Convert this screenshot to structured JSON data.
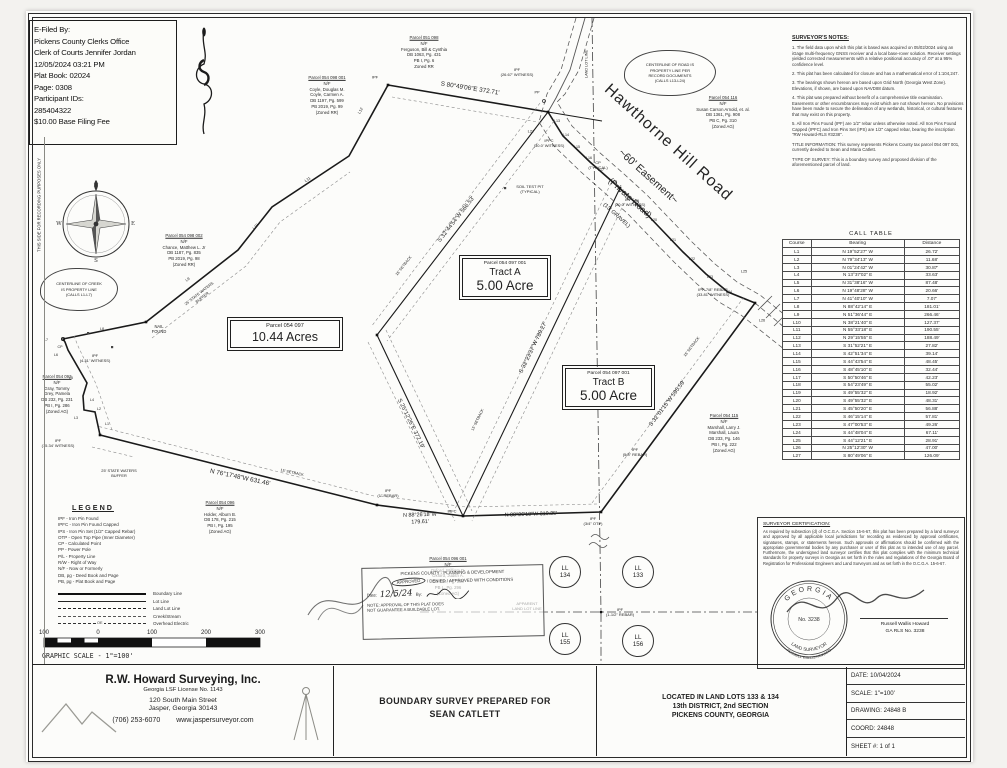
{
  "efile": {
    "lines": [
      "E-Filed By:",
      "Pickens County Clerks Office",
      "Clerk of Courts Jennifer Jordan",
      "12/05/2024 03:21 PM",
      "Plat Book: 02024",
      "Page: 0308",
      "Participant IDs:",
      "285404322",
      "$10.00 Base Filing Fee"
    ]
  },
  "surveyor_notes": {
    "title": "SURVEYOR'S NOTES:",
    "paragraphs": [
      "1. The field data upon which this plat is based was acquired on 05/02/2024 using an iGage multi-frequency GNSS receiver and a local base-rover solution. Receiver settings yielded corrected measurements with a relative positional accuracy of .07' at a 95% confidence level.",
      "2. This plat has been calculated for closure and has a mathematical error of 1:104,247.",
      "3. The bearings shown hereon are based upon Grid North (Georgia West Zone). Elevations, if shown, are based upon NAVD88 datum.",
      "4. This plat was prepared without benefit of a comprehensive title examination. Easements or other encumbrances may exist which are not shown hereon. No provisions have been made to secure the delineation of any wetlands, historical, or cultural features that may exist on this property.",
      "5. All Iron Pins Found (IPF) are 1/2\" rebar unless otherwise noted. All Iron Pins Found Capped (IPFC) and Iron Pins Set (IPS) are 1/2\" capped rebar, bearing the inscription \"RW Howard-RLS #3238\".",
      "TITLE INFORMATION: This survey represents Pickens County tax parcel 054 097 001, currently deeded to Sean and Maria Catlett.",
      "TYPE OF SURVEY: This is a boundary survey and proposed division of the aforementioned parcel of land."
    ]
  },
  "call_table": {
    "title": "CALL TABLE",
    "headers": [
      "Course",
      "Bearing",
      "Distance"
    ],
    "rows": [
      {
        "c": "L1",
        "b": "N 19°52'27\" W",
        "d": "26.72'"
      },
      {
        "c": "L2",
        "b": "N 79°34'13\" W",
        "d": "11.68'"
      },
      {
        "c": "L3",
        "b": "N 01°24'42\" W",
        "d": "30.87'"
      },
      {
        "c": "L4",
        "b": "N 13°37'02\" E",
        "d": "33.63'"
      },
      {
        "c": "L5",
        "b": "N 31°38'16\" W",
        "d": "87.48'"
      },
      {
        "c": "L6",
        "b": "N 19°48'28\" W",
        "d": "20.66'"
      },
      {
        "c": "L7",
        "b": "N 41°40'10\" W",
        "d": "7.07'"
      },
      {
        "c": "L8",
        "b": "N 88°42'14\" E",
        "d": "181.01'"
      },
      {
        "c": "L9",
        "b": "N 51°36'44\" E",
        "d": "266.46'"
      },
      {
        "c": "L10",
        "b": "N 38°21'40\" E",
        "d": "127.37'"
      },
      {
        "c": "L11",
        "b": "N 55°33'18\" E",
        "d": "190.55'"
      },
      {
        "c": "L12",
        "b": "N 29°15'55\" E",
        "d": "188.49'"
      },
      {
        "c": "L13",
        "b": "S 31°52'21\" E",
        "d": "27.82'"
      },
      {
        "c": "L14",
        "b": "S 42°51'34\" E",
        "d": "39.14'"
      },
      {
        "c": "L15",
        "b": "S 44°43'54\" E",
        "d": "48.45'"
      },
      {
        "c": "L16",
        "b": "S 48°45'10\" E",
        "d": "32.44'"
      },
      {
        "c": "L17",
        "b": "S 50°50'46\" E",
        "d": "42.23'"
      },
      {
        "c": "L18",
        "b": "S 54°23'49\" E",
        "d": "55.02'"
      },
      {
        "c": "L19",
        "b": "S 49°55'32\" E",
        "d": "18.92'"
      },
      {
        "c": "L20",
        "b": "S 49°55'32\" E",
        "d": "48.31'"
      },
      {
        "c": "L21",
        "b": "S 45°50'20\" E",
        "d": "56.88'"
      },
      {
        "c": "L22",
        "b": "S 46°15'14\" E",
        "d": "57.81'"
      },
      {
        "c": "L23",
        "b": "S 47°00'53\" E",
        "d": "49.26'"
      },
      {
        "c": "L24",
        "b": "S 44°48'04\" E",
        "d": "67.11'"
      },
      {
        "c": "L25",
        "b": "S 44°12'21\" E",
        "d": "28.91'"
      },
      {
        "c": "L26",
        "b": "N 25°12'30\" W",
        "d": "47.00'"
      },
      {
        "c": "L27",
        "b": "S 80°49'06\" E",
        "d": "126.09'"
      }
    ]
  },
  "road": {
    "name": "Hawthorne Hill Road",
    "easement": "~60' Easement~",
    "type": "(Private Road)",
    "surface": "(13' GRAVEL)"
  },
  "clouds": {
    "road": "CENTERLINE OF ROAD IS\nPROPERTY LINE PER\nRECORD DOCUMENTS\n(CALLS L13-L24)",
    "creek": "CENTERLINE OF CREEK\nIS PROPERTY LINE\n(CALLS L1-L7)"
  },
  "tracts": {
    "a": {
      "parcel": "Parcel 054 097 001",
      "name": "Tract A",
      "area": "5.00 Acre"
    },
    "b": {
      "parcel": "Parcel 054 097 001",
      "name": "Tract B",
      "area": "5.00 Acre"
    },
    "remainder": {
      "parcel": "Parcel 054 097",
      "area": "10.44 Acres"
    }
  },
  "adjoiners": [
    {
      "name": "parcel-ferguson",
      "x": 424,
      "y": 52,
      "w": 92,
      "lines": [
        "Parcel 051 098",
        "N/F",
        "Ferguson, Bill & Cynthia",
        "DB 1063, Pg. 431",
        "PB I, Pg. 6",
        "Zoned RR"
      ]
    },
    {
      "name": "parcel-coyle",
      "x": 327,
      "y": 95,
      "w": 66,
      "lines": [
        "Parcel 054 098 001",
        "N/F",
        "Coyle, Douglas M.",
        "Coyle, Carmen A.",
        "DB 1197, Pg. 599",
        "PB 2019, Pg. 99",
        "(Zoned RR)"
      ]
    },
    {
      "name": "parcel-chance",
      "x": 184,
      "y": 250,
      "w": 72,
      "lines": [
        "Parcel 054 098 002",
        "N/F",
        "Chance, Matthew L. Jr",
        "DB 1187, Pg. 835",
        "PB 2019, Pg. 98",
        "(Zoned RR)"
      ]
    },
    {
      "name": "parcel-gray",
      "x": 57,
      "y": 394,
      "w": 58,
      "lines": [
        "Parcel 054 093",
        "N/F",
        "Gray, Tommy",
        "Grey, Pamela",
        "DB 232, Pg. 231",
        "PB I, Pg. 286",
        "(Zoned AG)"
      ]
    },
    {
      "name": "parcel-arnold",
      "x": 723,
      "y": 112,
      "w": 82,
      "lines": [
        "Parcel 054 116",
        "N/F",
        "Susan Carson Arnold, et. al.",
        "DB 1361, Pg. 908",
        "PB C, Pg. 310",
        "(Zoned AG)"
      ]
    },
    {
      "name": "parcel-marshall",
      "x": 724,
      "y": 433,
      "w": 66,
      "lines": [
        "Parcel 054 115",
        "N/F",
        "Marshall, Larry J.",
        "Marshall, Laura",
        "DB 233, Pg. 146",
        "PB I, Pg. 222",
        "(Zoned AG)"
      ]
    },
    {
      "name": "parcel-holder",
      "x": 220,
      "y": 517,
      "w": 62,
      "lines": [
        "Parcel 054 096",
        "N/F",
        "Holder, Alburn B.",
        "DB 178, Pg. 215",
        "PB I, Pg. 195",
        "(Zoned AG)"
      ]
    },
    {
      "name": "parcel-oxford",
      "x": 448,
      "y": 576,
      "w": 66,
      "lines": [
        "Parcel 054 096 001",
        "N/F",
        "Oxford, William D.",
        "Oxford, Judith A.",
        "DB 136, Pg. 198",
        "PB L, Pg. 296",
        "(Zoned AG)"
      ]
    }
  ],
  "map_labels": [
    {
      "n": "bearing-top",
      "t": "S 80°49'06\"E 372.71'",
      "x": 470,
      "y": 89,
      "r": 9,
      "s": 6.3
    },
    {
      "n": "bearing-interior-1",
      "t": "S 32°44'54\"W 566.53'",
      "x": 457,
      "y": 220,
      "r": -52,
      "s": 5.8
    },
    {
      "n": "bearing-interior-2",
      "t": "S 25°12'26\"E 372.19'",
      "x": 410,
      "y": 424,
      "r": 64,
      "s": 5.8
    },
    {
      "n": "bearing-division",
      "t": "S 32°23'37\"W 789.27'",
      "x": 534,
      "y": 348,
      "r": -64,
      "s": 5.8
    },
    {
      "n": "bearing-right",
      "t": "S 32°01'15\"W 595.59'",
      "x": 668,
      "y": 404,
      "r": -53,
      "s": 5.8
    },
    {
      "n": "bearing-bottom-1",
      "t": "N 76°17'48\"W 631.46'",
      "x": 240,
      "y": 478,
      "r": 12,
      "s": 6.3
    },
    {
      "n": "bearing-bottom-2",
      "t": "N 88°26'18\"W\n179.61'",
      "x": 420,
      "y": 519,
      "r": -2,
      "s": 5.4
    },
    {
      "n": "bearing-bottom-3",
      "t": "N 88°26'18\"W 310.25'",
      "x": 531,
      "y": 515,
      "r": -2,
      "s": 5.4
    },
    {
      "n": "nail-found-label",
      "t": "NAIL\nFOUND",
      "x": 159,
      "y": 329,
      "r": 0,
      "s": 4.1
    },
    {
      "n": "ipf-witness-431",
      "t": "IPF\n(4.31' WITNESS)",
      "x": 95,
      "y": 358,
      "r": 0,
      "s": 4
    },
    {
      "n": "ipf-witness-1534",
      "t": "IPF\n(15.34' WITNESS)",
      "x": 58,
      "y": 443,
      "r": 0,
      "s": 4
    },
    {
      "n": "ipf-corner-a",
      "t": "IPF",
      "x": 375,
      "y": 77,
      "r": 0,
      "s": 4
    },
    {
      "n": "ipf-witness-2667",
      "t": "IPF\n(26.67' WITNESS)",
      "x": 517,
      "y": 72,
      "r": 0,
      "s": 4
    },
    {
      "n": "ipfc-witness-300",
      "t": "IPFC\n(30.0' WITNESS)",
      "x": 549,
      "y": 143,
      "r": 0,
      "s": 4
    },
    {
      "n": "ipfc-witness-200",
      "t": "IPFC\n(20.0' WITNESS)",
      "x": 630,
      "y": 202,
      "r": 0,
      "s": 4
    },
    {
      "n": "cp-typical",
      "t": "CP\n(TYPICAL)",
      "x": 598,
      "y": 165,
      "r": 0,
      "s": 4
    },
    {
      "n": "soil-test-pit",
      "t": "SOIL TEST PIT\n(TYPICAL)",
      "x": 530,
      "y": 189,
      "r": 0,
      "s": 4
    },
    {
      "n": "ipf-78-rebar",
      "t": "IPF-7/8\" REBAR\n(33.81' WITNESS)",
      "x": 713,
      "y": 292,
      "r": 0,
      "s": 4
    },
    {
      "n": "ipf-58-rebar",
      "t": "IPF\n(5/8\" REBAR)",
      "x": 635,
      "y": 452,
      "r": 0,
      "s": 4
    },
    {
      "n": "ipf-34-otp",
      "t": "IPF\n(3/4\" OTP)",
      "x": 593,
      "y": 521,
      "r": 0,
      "s": 4
    },
    {
      "n": "ipfc-bottom",
      "t": "IPFC",
      "x": 452,
      "y": 511,
      "r": 0,
      "s": 4
    },
    {
      "n": "ipf-1in-rebar",
      "t": "IPF\n(1\" REBAR)",
      "x": 388,
      "y": 493,
      "r": 0,
      "s": 4
    },
    {
      "n": "ipf-112-rebar",
      "t": "IPF\n(1-1/2\" REBAR)",
      "x": 620,
      "y": 612,
      "r": 0,
      "s": 4
    },
    {
      "n": "apparent-land-lot-line",
      "t": "APPARENT\nLAND LOT LINE",
      "x": 527,
      "y": 606,
      "r": 0,
      "s": 4
    },
    {
      "n": "land-lot-line-top",
      "t": "LAND LOT LINE",
      "x": 587,
      "y": 64,
      "r": -90,
      "s": 3.8
    },
    {
      "n": "state-waters-buffer-diag",
      "t": "25' STATE WATERS\nBUFFER",
      "x": 201,
      "y": 296,
      "r": -38,
      "s": 3.9
    },
    {
      "n": "state-waters-buffer-bottom",
      "t": "25' STATE WATERS\nBUFFER",
      "x": 119,
      "y": 474,
      "r": 0,
      "s": 3.9
    },
    {
      "n": "setback-bottom",
      "t": "15' SETBACK",
      "x": 292,
      "y": 473,
      "r": 12,
      "s": 3.8
    },
    {
      "n": "setback-i1",
      "t": "15' SETBACK",
      "x": 404,
      "y": 266,
      "r": -52,
      "s": 3.8
    },
    {
      "n": "setback-division",
      "t": "15' SETBACK",
      "x": 478,
      "y": 420,
      "r": -64,
      "s": 3.8
    },
    {
      "n": "setback-right",
      "t": "15' SETBACK",
      "x": 692,
      "y": 347,
      "r": -53,
      "s": 3.8
    },
    {
      "n": "call-l13",
      "t": "L13",
      "x": 557,
      "y": 121,
      "r": 0,
      "s": 3.6
    },
    {
      "n": "call-l14",
      "t": "L14",
      "x": 566,
      "y": 135,
      "r": 0,
      "s": 3.6
    },
    {
      "n": "call-l15",
      "t": "L15",
      "x": 577,
      "y": 147,
      "r": 0,
      "s": 3.6
    },
    {
      "n": "call-l16",
      "t": "L16",
      "x": 589,
      "y": 158,
      "r": 0,
      "s": 3.6
    },
    {
      "n": "call-l17",
      "t": "L17",
      "x": 601,
      "y": 170,
      "r": 0,
      "s": 3.6
    },
    {
      "n": "call-l18",
      "t": "L18",
      "x": 614,
      "y": 182,
      "r": 0,
      "s": 3.6
    },
    {
      "n": "call-l19",
      "t": "L19",
      "x": 636,
      "y": 201,
      "r": 0,
      "s": 3.6
    },
    {
      "n": "call-l20",
      "t": "L20",
      "x": 654,
      "y": 220,
      "r": 0,
      "s": 3.6
    },
    {
      "n": "call-l21",
      "t": "L21",
      "x": 673,
      "y": 240,
      "r": 0,
      "s": 3.6
    },
    {
      "n": "call-l22",
      "t": "L22",
      "x": 692,
      "y": 259,
      "r": 0,
      "s": 3.6
    },
    {
      "n": "call-l23",
      "t": "L23",
      "x": 710,
      "y": 277,
      "r": 0,
      "s": 3.6
    },
    {
      "n": "call-l24",
      "t": "L24",
      "x": 729,
      "y": 292,
      "r": 0,
      "s": 3.6
    },
    {
      "n": "call-l25",
      "t": "L25",
      "x": 744,
      "y": 272,
      "r": 0,
      "s": 3.8
    },
    {
      "n": "call-l26",
      "t": "L26",
      "x": 762,
      "y": 321,
      "r": 0,
      "s": 3.8
    },
    {
      "n": "call-l27",
      "t": "L27",
      "x": 531,
      "y": 131,
      "r": 0,
      "s": 4
    },
    {
      "n": "call-l1",
      "t": "L1",
      "x": 107,
      "y": 424,
      "r": 0,
      "s": 3.6
    },
    {
      "n": "call-l2",
      "t": "L2",
      "x": 99,
      "y": 409,
      "r": 0,
      "s": 3.6
    },
    {
      "n": "call-l3",
      "t": "L3",
      "x": 76,
      "y": 418,
      "r": 0,
      "s": 3.6
    },
    {
      "n": "call-l4",
      "t": "L4",
      "x": 92,
      "y": 400,
      "r": 0,
      "s": 3.6
    },
    {
      "n": "call-l5",
      "t": "L5",
      "x": 71,
      "y": 378,
      "r": 0,
      "s": 3.6
    },
    {
      "n": "call-l6",
      "t": "L6",
      "x": 56,
      "y": 355,
      "r": 0,
      "s": 3.6
    },
    {
      "n": "call-l7",
      "t": "L7",
      "x": 46,
      "y": 340,
      "r": 0,
      "s": 3.6
    },
    {
      "n": "cp-point",
      "t": "CP",
      "x": 60,
      "y": 347,
      "r": 0,
      "s": 3.6
    },
    {
      "n": "call-l8",
      "t": "L8",
      "x": 102,
      "y": 329,
      "r": 0,
      "s": 3.6
    },
    {
      "n": "call-l9",
      "t": "L9",
      "x": 188,
      "y": 280,
      "r": -38,
      "s": 3.9
    },
    {
      "n": "call-l10",
      "t": "L10",
      "x": 256,
      "y": 227,
      "r": -48,
      "s": 3.9
    },
    {
      "n": "call-l11",
      "t": "L11",
      "x": 308,
      "y": 180,
      "r": -34,
      "s": 3.9
    },
    {
      "n": "call-l12",
      "t": "L12",
      "x": 361,
      "y": 111,
      "r": -61,
      "s": 3.9
    },
    {
      "n": "power-pole",
      "t": "PP",
      "x": 537,
      "y": 93,
      "r": 0,
      "s": 3.8
    },
    {
      "n": "recording-margin-note",
      "t": "THIS SIDE FOR RECORDING PURPOSES ONLY",
      "x": 39,
      "y": 205,
      "r": -90,
      "s": 4.2
    }
  ],
  "ll_circles": [
    {
      "t": "LL",
      "num": "134",
      "x": 565,
      "y": 572
    },
    {
      "t": "LL",
      "num": "133",
      "x": 638,
      "y": 572
    },
    {
      "t": "LL",
      "num": "155",
      "x": 565,
      "y": 639
    },
    {
      "t": "LL",
      "num": "156",
      "x": 638,
      "y": 641
    }
  ],
  "legend": {
    "title": "LEGEND",
    "abbreviations": [
      "IPF - Iron Pin Found",
      "IPFC - Iron Pin Found Capped",
      "IPS - Iron Pin Set (1/2\" Capped Rebar)",
      "OTP - Open Top Pipe (Inner Diameter)",
      "CP - Calculated Point",
      "PP - Power Pole",
      "P/L - Property Line",
      "R/W - Right of Way",
      "N/F - Now or Formerly",
      "DB, pg - Deed Book and Page",
      "PB, pg - Plat Book and Page"
    ],
    "line_types": [
      {
        "label": "Boundary Line",
        "style": "boundary",
        "tag": ""
      },
      {
        "label": "Lot Line",
        "style": "lot",
        "tag": ""
      },
      {
        "label": "Land Lot Line",
        "style": "landlot",
        "tag": ""
      },
      {
        "label": "Creek/Stream",
        "style": "creek",
        "tag": ""
      },
      {
        "label": "Overhead Electric",
        "style": "oe",
        "tag": "OE"
      }
    ]
  },
  "scale_bar": {
    "numbers": [
      {
        "t": "100",
        "x": 8
      },
      {
        "t": "0",
        "x": 62
      },
      {
        "t": "100",
        "x": 116
      },
      {
        "t": "200",
        "x": 170
      },
      {
        "t": "300",
        "x": 224
      }
    ],
    "caption": "GRAPHIC SCALE - 1\"=100'"
  },
  "stamp": {
    "header": "PICKENS COUNTY - PLANNING & DEVELOPMENT",
    "approved": "APPROVED",
    "options_rest": "/ DENIED / APPROVED WITH CONDITIONS",
    "date_label": "Date:",
    "date_value": "12/5/24",
    "by_label": "By:",
    "note": "NOTE: APPROVAL OF THIS PLAT DOES\nNOT GUARANTEE A BUILDABLE LOT."
  },
  "certification": {
    "title": "SURVEYOR CERTIFICATION:",
    "text": "As required by subsection (d) of O.C.G.A. Section 15-6-67, this plat has been prepared by a land surveyor and approved by all applicable local jurisdictions for recording as evidenced by approval certificates, signatures, stamps, or statements hereon. Such approvals or affirmations should be confirmed with the appropriate governmental bodies by any purchaser or user of this plat as to intended use of any parcel. Furthermore, the undersigned land surveyor certifies that this plat complies with the minimum technical standards for property surveys in Georgia as set forth in the rules and regulations of the Georgia Board of Registration for Professional Engineers and Land Surveyors and as set forth in the O.C.G.A. 15-6-67.",
    "signer": "Russell Wallis Howard",
    "license": "GA RLS No. 3238"
  },
  "seal": {
    "state": "GEORGIA",
    "number": "No. 3238",
    "role": "LAND SURVEYOR",
    "name": "RUSSELL WALLIS HOWARD"
  },
  "compass": {
    "n": "N",
    "e": "E",
    "s": "S",
    "w": "W"
  },
  "title_block": {
    "company": {
      "name": "R.W. Howard Surveying, Inc.",
      "license": "Georgia LSF License No. 1143",
      "street": "120 South Main Street",
      "city": "Jasper, Georgia 30143",
      "phone": "(706) 253-6070",
      "website": "www.jaspersurveyor.com"
    },
    "prepared": {
      "line1": "BOUNDARY SURVEY PREPARED FOR",
      "line2": "SEAN CATLETT"
    },
    "location": {
      "line1": "LOCATED IN LAND LOTS 133 & 134",
      "line2": "13th DISTRICT, 2nd SECTION",
      "line3": "PICKENS COUNTY, GEORGIA"
    },
    "info": [
      "DATE: 10/04/2024",
      "SCALE: 1\"=100'",
      "DRAWING: 24848 B",
      "COORD: 24848",
      "SHEET #: 1 of 1"
    ]
  }
}
